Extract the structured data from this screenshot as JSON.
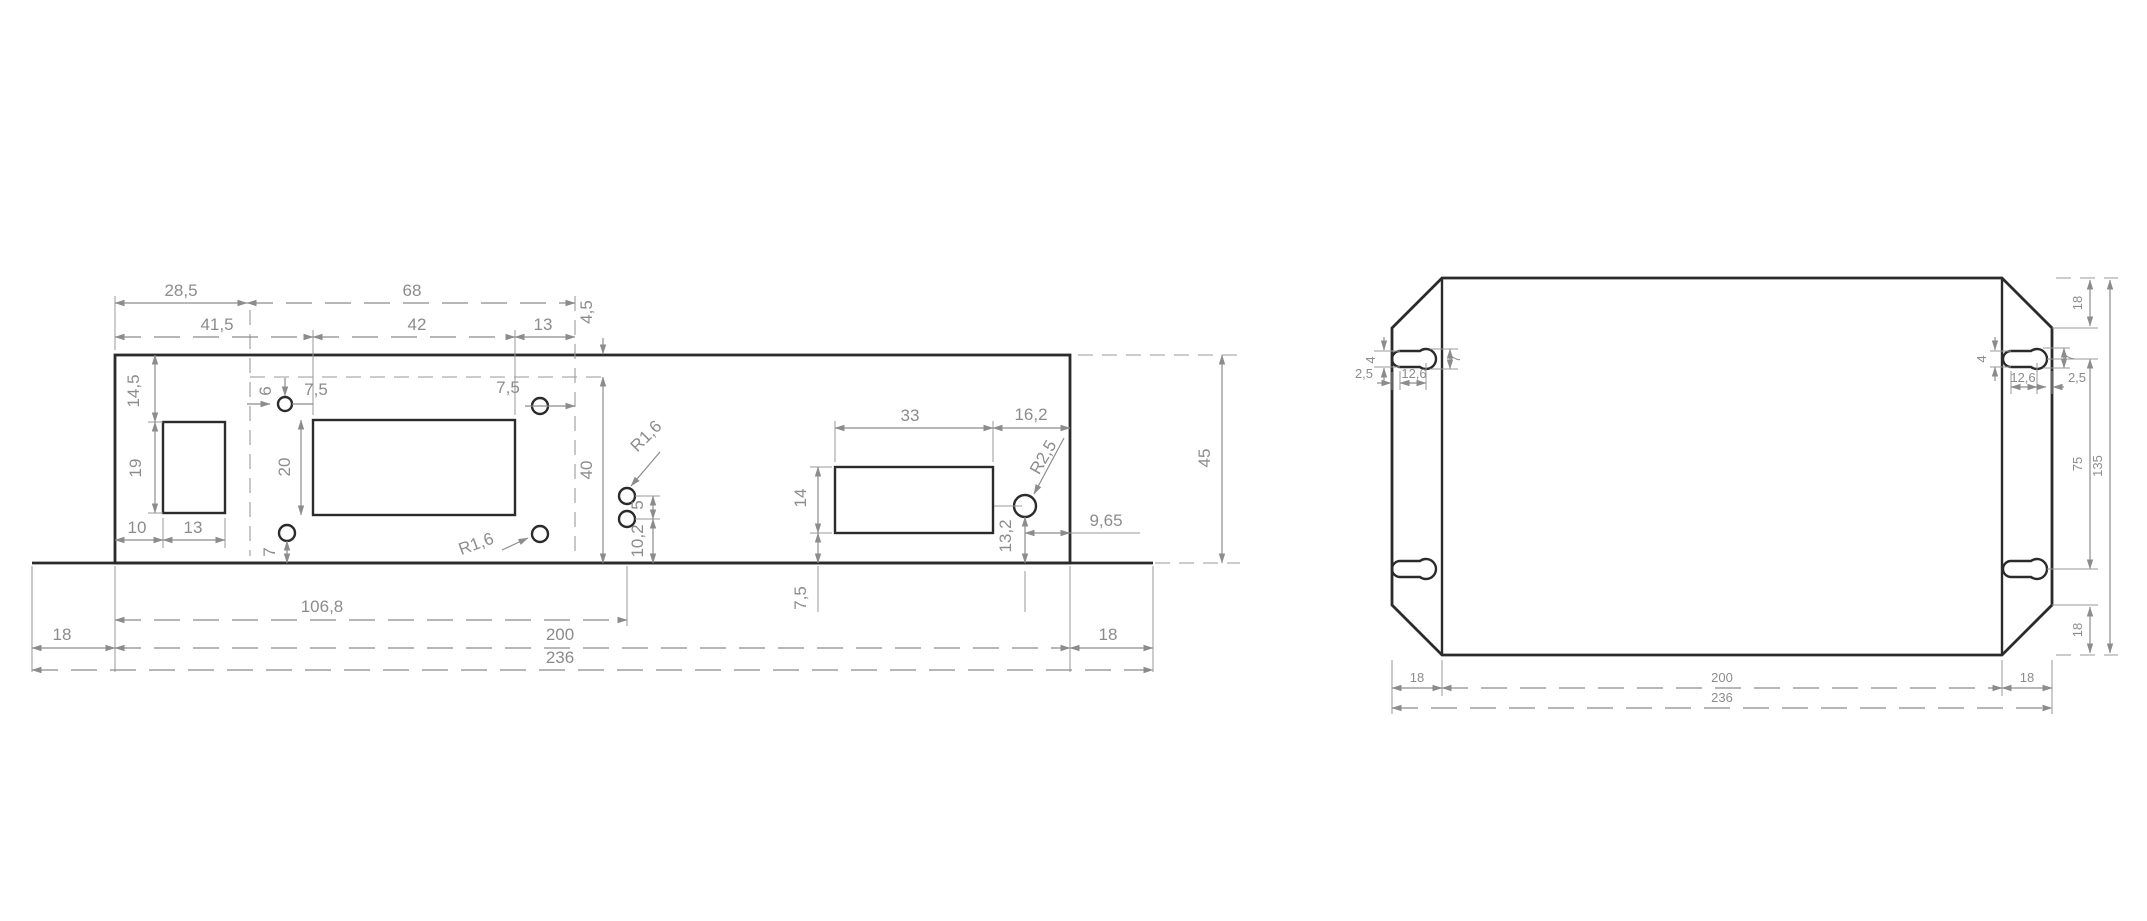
{
  "colors": {
    "outline": "#2b2b2b",
    "dimension": "#8c8c8c",
    "background": "#ffffff"
  },
  "front_view": {
    "dims": {
      "t28_5": "28,5",
      "t41_5": "41,5",
      "t68": "68",
      "t42": "42",
      "t13": "13",
      "t4_5": "4,5",
      "t14_5": "14,5",
      "t19": "19",
      "t10": "10",
      "t13b": "13",
      "t6": "6",
      "t7_5l": "7,5",
      "t7_5r": "7,5",
      "t20": "20",
      "t7": "7",
      "r1_6a": "R1,6",
      "r1_6b": "R1,6",
      "t40": "40",
      "t10_2": "10,2",
      "t5": "5",
      "t33": "33",
      "t16_2": "16,2",
      "r2_5": "R2,5",
      "t14": "14",
      "t13_2": "13,2",
      "t9_65": "9,65",
      "t7_5b": "7,5",
      "t106_8": "106,8",
      "t18l": "18",
      "t200": "200",
      "t236": "236",
      "t18r": "18",
      "t45": "45"
    }
  },
  "plan_view": {
    "dims": {
      "tl4": "4",
      "tl2_5": "2,5",
      "tl12_6": "12,6",
      "tl7": "7",
      "tr4": "4",
      "tr12_6": "12,6",
      "tr2_5": "2,5",
      "tr7": "7",
      "tr18": "18",
      "r75": "75",
      "r135": "135",
      "br18": "18",
      "b18l": "18",
      "b200": "200",
      "b236": "236",
      "b18r": "18"
    }
  }
}
